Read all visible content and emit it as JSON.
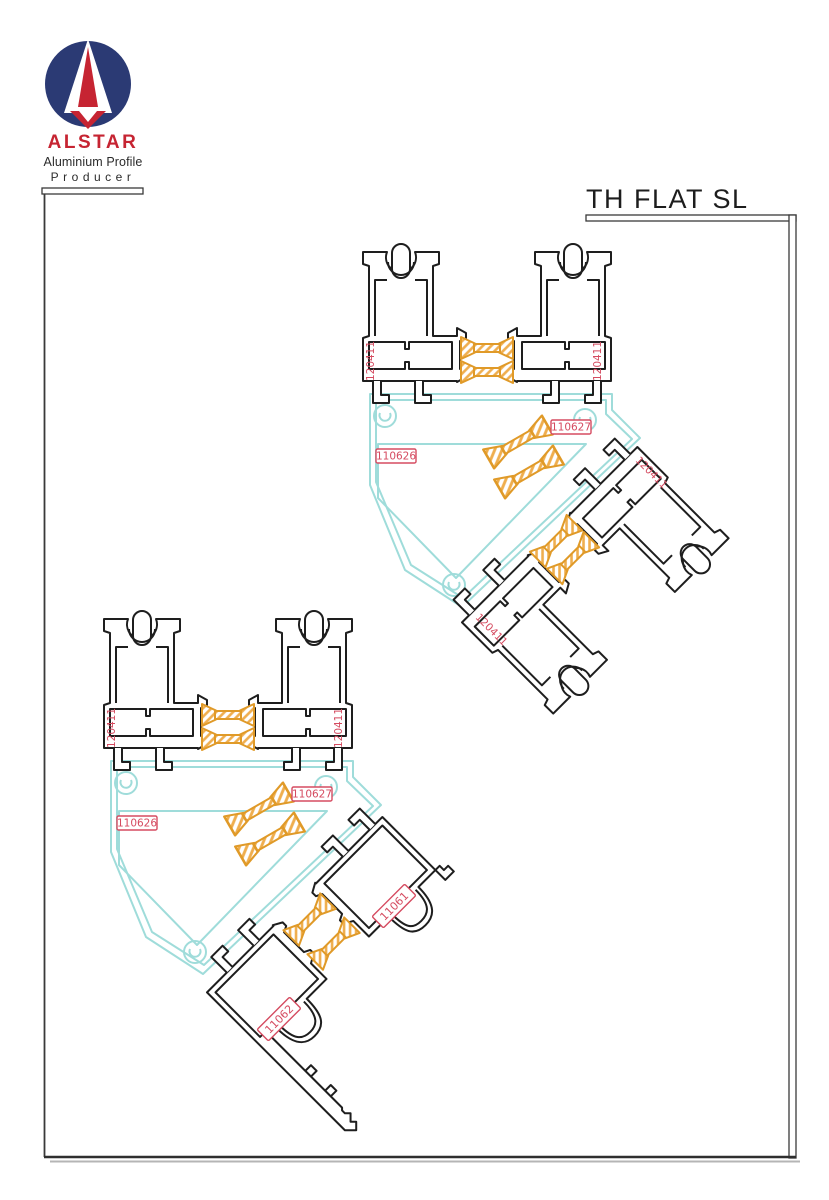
{
  "page": {
    "title": "TH FLAT SL"
  },
  "logo": {
    "brand": "ALSTAR",
    "tagline_line1": "Aluminium Profile",
    "tagline_line2": "Producer",
    "mark": "alstar-a-mark"
  },
  "colors": {
    "profile_outline": "#1e1e1e",
    "insulator_orange": "#e09a28",
    "adapter_cyan": "#9fdcda",
    "label_red": "#d54b60",
    "logo_navy": "#2b3a74",
    "logo_red": "#c62432"
  },
  "labels": {
    "upper_assembly": {
      "frame_left": "120411",
      "frame_right": "120411",
      "adapter": "110626",
      "thermal_break": "110627",
      "sash_upper": "120411",
      "sash_lower": "120411"
    },
    "lower_assembly": {
      "frame_left": "120411",
      "frame_right": "120411",
      "adapter": "110626",
      "thermal_break": "110627",
      "threshold_upper": "11061",
      "threshold_lower": "11062"
    }
  }
}
